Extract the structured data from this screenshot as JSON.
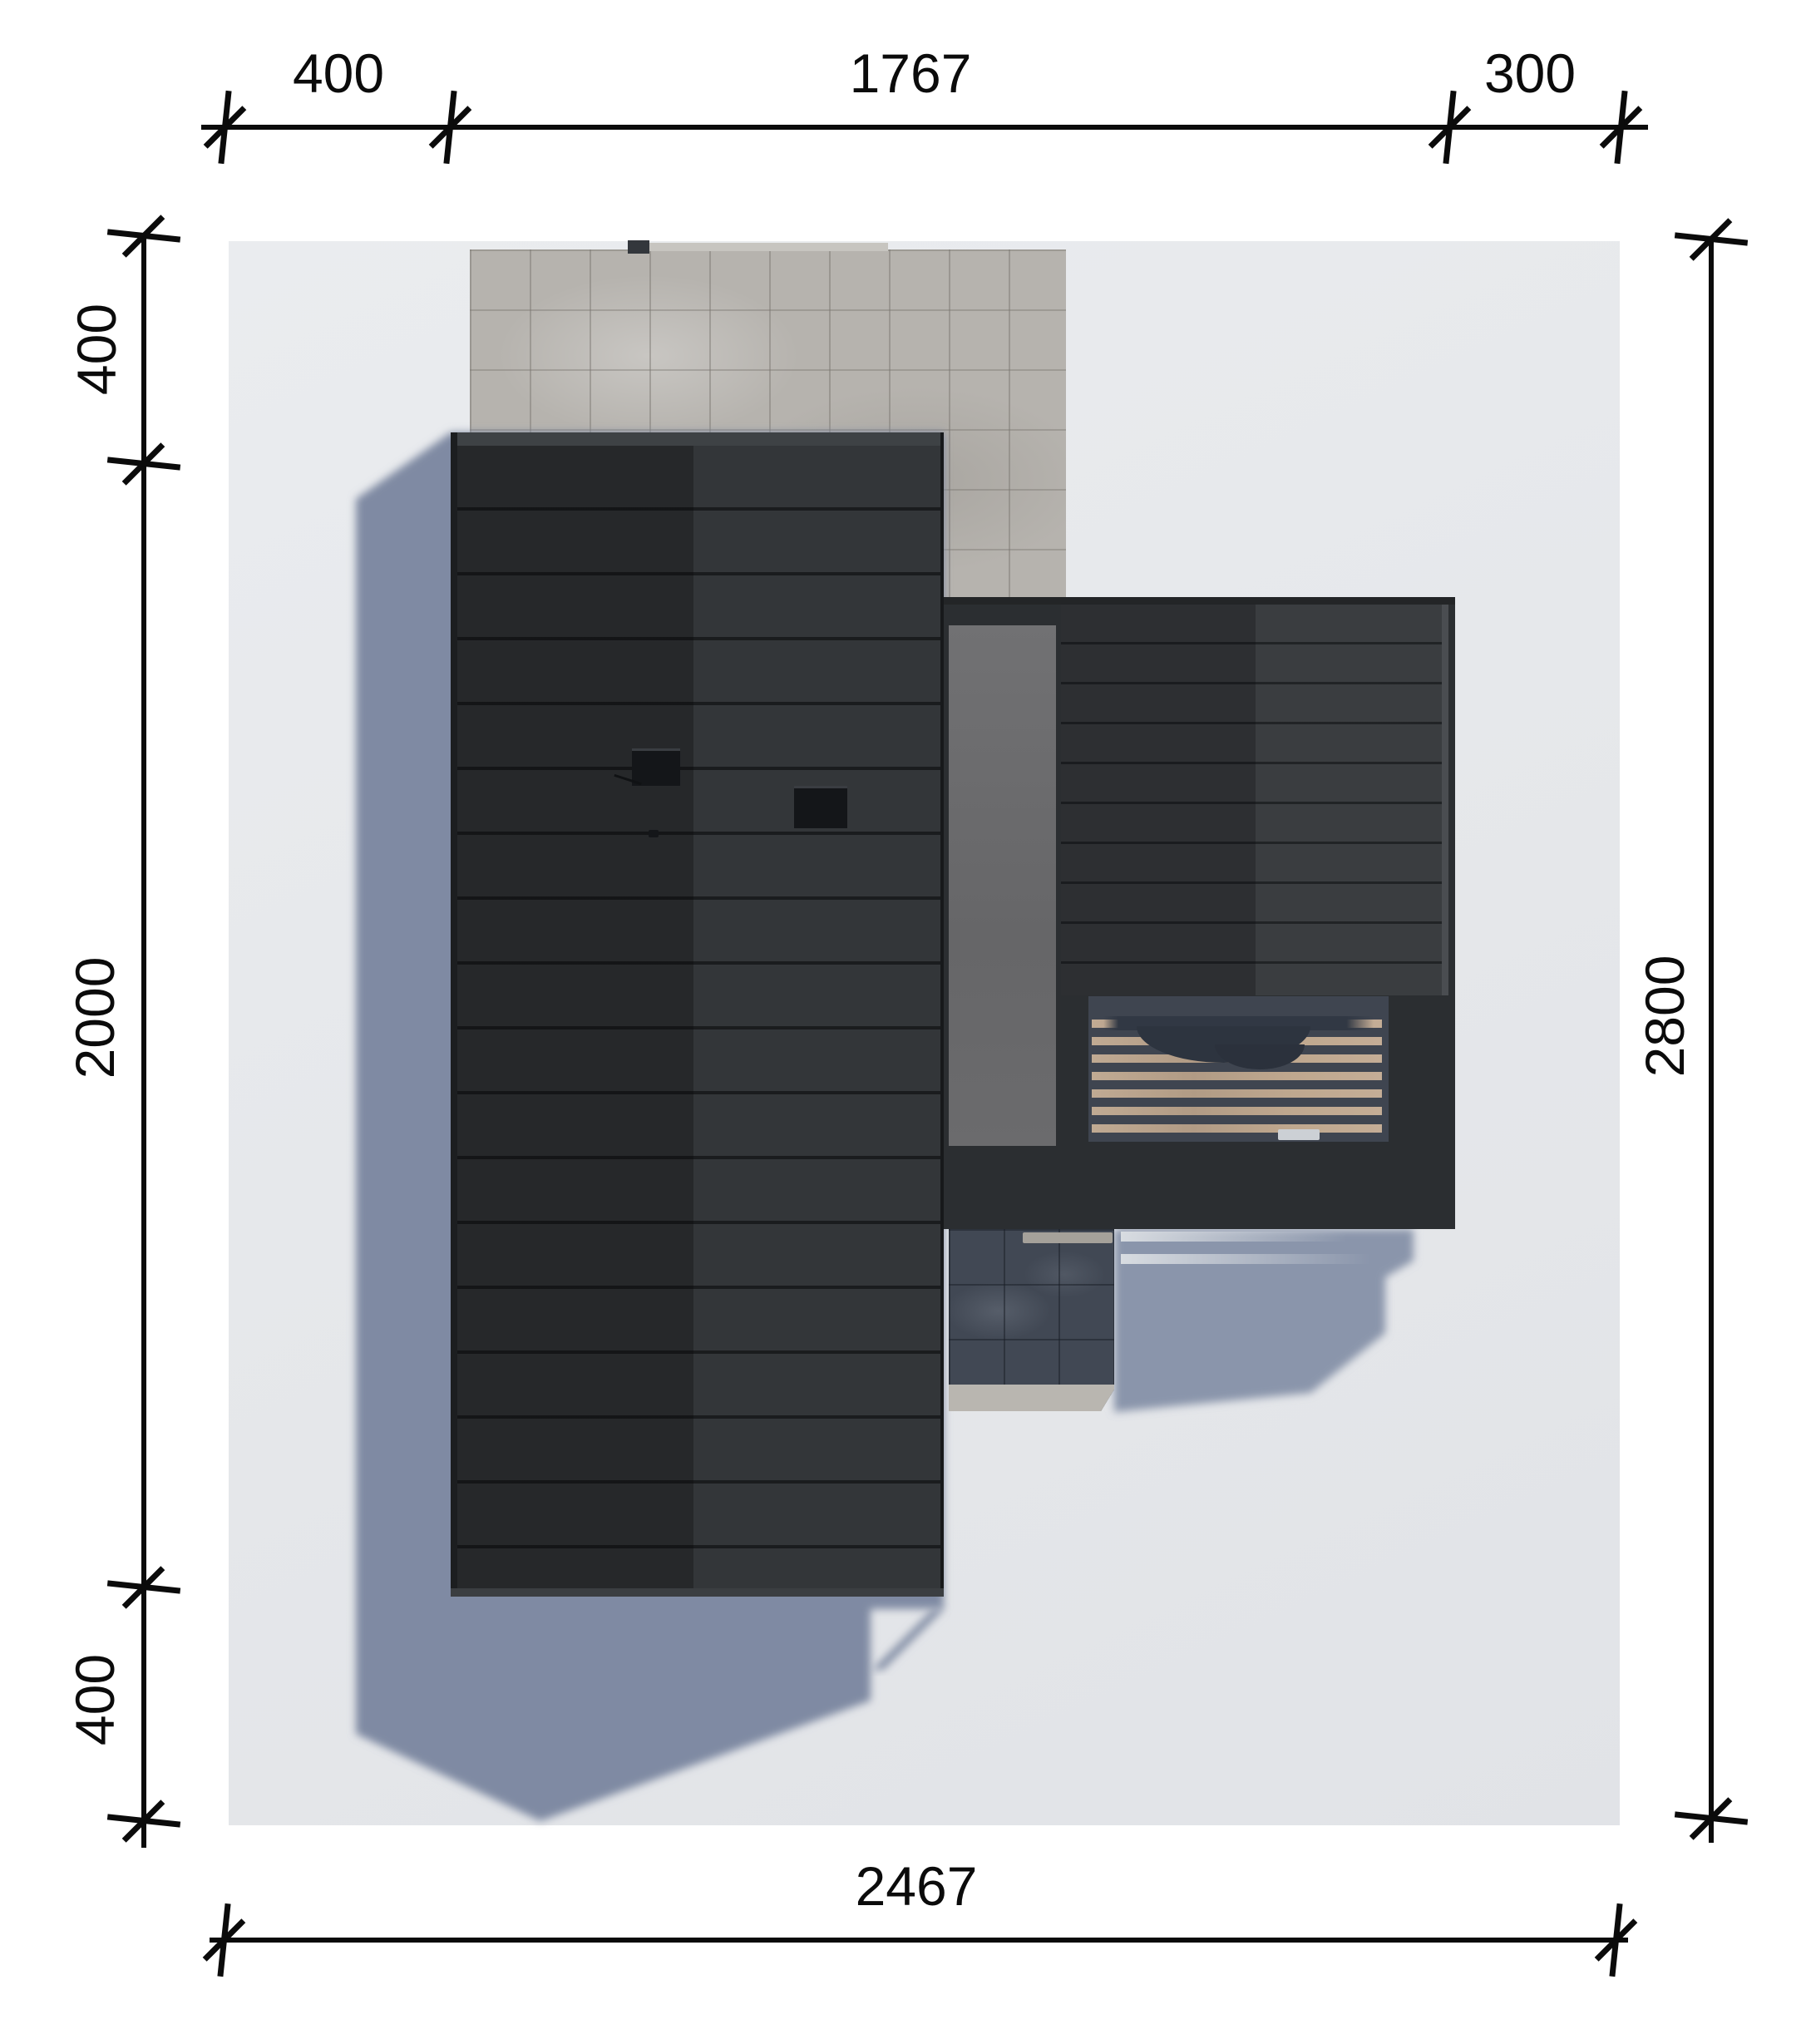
{
  "drawing": {
    "kind": "roof-plan-top-view",
    "dimensions": {
      "top": [
        "400",
        "1767",
        "300"
      ],
      "bottom": [
        "2467"
      ],
      "left": [
        "400",
        "2000",
        "400"
      ],
      "right": [
        "2800"
      ]
    },
    "colors": {
      "page_bg": "#ffffff",
      "plot_bg": "#e7e9ec",
      "roof_dark": "#26282a",
      "roof_light": "#333639",
      "concrete_paver": "#b6b3ae",
      "gray_flat_roof": "#6a6a6c",
      "wood_slat": "#bba58e",
      "walkway_dark": "#414854",
      "shadow_blue": "#8490a6",
      "dimension_ink": "#0b0b0b"
    }
  }
}
